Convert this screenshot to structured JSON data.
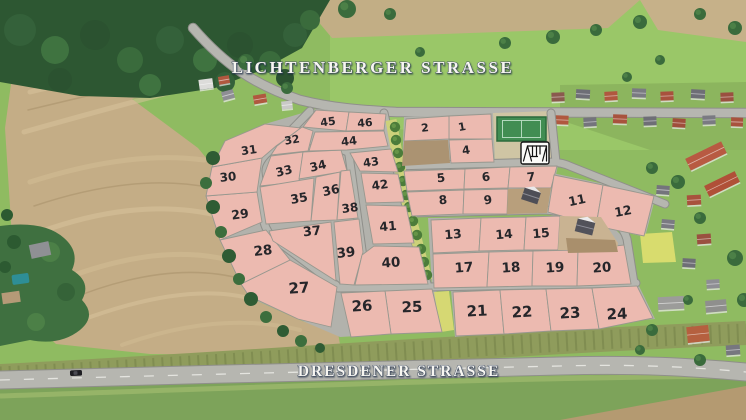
{
  "title": "Baugebiet Luftbild mit Grundstuecken",
  "streets": {
    "top": "LICHTENBERGER STRASSE",
    "bottom": "DRESDENER STRASSE"
  },
  "colors": {
    "plot_fill": "#ecbab0",
    "plot_border": "#98988f",
    "road": "#b6b6b0",
    "road_asphalt": "#8b8b89",
    "number": "#26262a",
    "label_fill": "#f7f6f1",
    "label_outline": "#3c4960",
    "strip": "#ccd17a",
    "bush": "#4c7c3a",
    "court_green": "#418d52",
    "court_apron": "#cfc5a4",
    "field_tan": "#c4ad86",
    "meadow": "#8fbb61",
    "forest": "#2d5732"
  },
  "features": {
    "playground": {
      "icon": "swing-set-icon",
      "x": 521,
      "y": 142
    },
    "sports_court": {
      "name": "multi-sport-court",
      "x": 496,
      "y": 116
    },
    "car": {
      "name": "car-on-road",
      "x": 76,
      "y": 373
    }
  },
  "plots": [
    {
      "n": "1",
      "x": 462,
      "y": 127,
      "fs": 11,
      "rot": -10,
      "poly": "449,116 491,114 492,139 449,139"
    },
    {
      "n": "2",
      "x": 425,
      "y": 128,
      "fs": 11,
      "rot": -6,
      "poly": "406,119 449,116 449,139 404,141"
    },
    {
      "n": "4",
      "x": 466,
      "y": 150,
      "fs": 11.5,
      "rot": -8,
      "poly": "449,140 492,139 494,162 451,163"
    },
    {
      "n": "5",
      "x": 441,
      "y": 178,
      "fs": 12,
      "rot": -6,
      "poly": "404,171 465,169 464,189 407,191"
    },
    {
      "n": "6",
      "x": 486,
      "y": 177,
      "fs": 12,
      "rot": -8,
      "poly": "465,169 510,167 508,188 464,189"
    },
    {
      "n": "7",
      "x": 531,
      "y": 177,
      "fs": 12,
      "rot": -6,
      "poly": "510,167 557,166 551,188 508,188"
    },
    {
      "n": "8",
      "x": 443,
      "y": 200,
      "fs": 12,
      "rot": -5,
      "poly": "407,192 464,190 463,214 412,216"
    },
    {
      "n": "9",
      "x": 488,
      "y": 200,
      "fs": 12,
      "rot": -8,
      "poly": "464,190 508,189 507,214 463,214"
    },
    {
      "n": "11",
      "x": 577,
      "y": 200,
      "fs": 12.5,
      "rot": -12,
      "poly": "554,175 603,185 596,226 548,212"
    },
    {
      "n": "12",
      "x": 623,
      "y": 211,
      "fs": 12.5,
      "rot": -10,
      "poly": "603,185 654,196 644,236 596,226"
    },
    {
      "n": "13",
      "x": 453,
      "y": 234,
      "fs": 12.5,
      "rot": -5,
      "poly": "431,220 481,218 479,251 433,253"
    },
    {
      "n": "14",
      "x": 504,
      "y": 234,
      "fs": 12.5,
      "rot": -5,
      "poly": "481,218 526,217 524,250 479,251"
    },
    {
      "n": "15",
      "x": 541,
      "y": 233,
      "fs": 12.5,
      "rot": -5,
      "poly": "526,217 560,216 558,250 524,250"
    },
    {
      "n": "17",
      "x": 464,
      "y": 268,
      "fs": 13.5,
      "rot": -4,
      "poly": "433,254 489,252 487,287 434,288"
    },
    {
      "n": "18",
      "x": 511,
      "y": 268,
      "fs": 13.5,
      "rot": -4,
      "poly": "489,252 533,251 532,286 487,287"
    },
    {
      "n": "19",
      "x": 555,
      "y": 268,
      "fs": 13.5,
      "rot": -4,
      "poly": "533,251 578,250 577,286 532,286"
    },
    {
      "n": "20",
      "x": 602,
      "y": 268,
      "fs": 13.5,
      "rot": -4,
      "poly": "578,250 624,245 631,284 577,286"
    },
    {
      "n": "21",
      "x": 477,
      "y": 311,
      "fs": 15,
      "rot": -3,
      "poly": "453,292 500,290 504,334 456,336"
    },
    {
      "n": "22",
      "x": 522,
      "y": 312,
      "fs": 15,
      "rot": -3,
      "poly": "500,290 546,289 551,331 504,334"
    },
    {
      "n": "23",
      "x": 570,
      "y": 313,
      "fs": 15,
      "rot": -3,
      "poly": "546,289 592,288 599,329 551,331"
    },
    {
      "n": "24",
      "x": 617,
      "y": 314,
      "fs": 15,
      "rot": -3,
      "poly": "592,288 637,286 653,318 599,329"
    },
    {
      "n": "25",
      "x": 412,
      "y": 307,
      "fs": 15,
      "rot": -2,
      "poly": "385,291 432,289 442,332 391,334"
    },
    {
      "n": "26",
      "x": 362,
      "y": 306,
      "fs": 15,
      "rot": -3,
      "poly": "341,293 385,291 391,334 351,337"
    },
    {
      "n": "27",
      "x": 299,
      "y": 288,
      "fs": 15,
      "rot": -4,
      "poly": "241,284 290,260 337,287 331,327 298,319 249,296"
    },
    {
      "n": "28",
      "x": 263,
      "y": 251,
      "fs": 13.5,
      "rot": -6,
      "poly": "220,240 266,230 290,260 241,284"
    },
    {
      "n": "29",
      "x": 240,
      "y": 214,
      "fs": 12.5,
      "rot": -8,
      "poly": "206,196 257,192 262,222 220,240"
    },
    {
      "n": "30",
      "x": 228,
      "y": 177,
      "fs": 12,
      "rot": -6,
      "poly": "212,167 262,158 257,192 206,196"
    },
    {
      "n": "31",
      "x": 249,
      "y": 150,
      "fs": 11.5,
      "rot": -8,
      "poly": "225,141 265,124 301,128 276,146 262,158 212,167"
    },
    {
      "n": "32",
      "x": 292,
      "y": 140,
      "fs": 11,
      "rot": -10,
      "poly": "302,127 313,131 308,151 271,155 277,146"
    },
    {
      "n": "33",
      "x": 284,
      "y": 171,
      "fs": 12,
      "rot": -14,
      "poly": "271,156 303,152 299,182 260,186"
    },
    {
      "n": "34",
      "x": 318,
      "y": 166,
      "fs": 12,
      "rot": -14,
      "poly": "303,152 341,150 347,171 299,179"
    },
    {
      "n": "35",
      "x": 299,
      "y": 198,
      "fs": 12.5,
      "rot": -10,
      "poly": "260,187 314,178 311,221 266,224"
    },
    {
      "n": "36",
      "x": 331,
      "y": 190,
      "fs": 12.5,
      "rot": -12,
      "poly": "316,177 340,172 337,220 311,221"
    },
    {
      "n": "37",
      "x": 312,
      "y": 232,
      "fs": 13,
      "rot": -6,
      "poly": "269,231 331,222 336,281 273,241"
    },
    {
      "n": "38",
      "x": 350,
      "y": 208,
      "fs": 12,
      "rot": -8,
      "poly": "341,171 350,170 358,218 337,220"
    },
    {
      "n": "39",
      "x": 346,
      "y": 253,
      "fs": 13.5,
      "rot": -6,
      "poly": "334,222 359,219 363,252 354,285 340,284"
    },
    {
      "n": "40",
      "x": 391,
      "y": 263,
      "fs": 13.5,
      "rot": -4,
      "poly": "374,246 419,247 428,284 355,285 362,255"
    },
    {
      "n": "41",
      "x": 388,
      "y": 226,
      "fs": 12.5,
      "rot": -5,
      "poly": "366,205 406,206 414,243 373,244"
    },
    {
      "n": "42",
      "x": 380,
      "y": 185,
      "fs": 12,
      "rot": -8,
      "poly": "361,173 398,174 404,202 366,203"
    },
    {
      "n": "43",
      "x": 371,
      "y": 162,
      "fs": 11.5,
      "rot": -8,
      "poly": "350,153 391,149 398,172 360,171"
    },
    {
      "n": "44",
      "x": 349,
      "y": 141,
      "fs": 11.5,
      "rot": -6,
      "poly": "315,132 384,131 388,146 347,150 309,151"
    },
    {
      "n": "45",
      "x": 328,
      "y": 122,
      "fs": 11,
      "rot": -8,
      "poly": "316,110 349,112 346,131 303,127"
    },
    {
      "n": "46",
      "x": 365,
      "y": 123,
      "fs": 11,
      "rot": -5,
      "poly": "349,112 386,114 384,130 346,131"
    }
  ]
}
